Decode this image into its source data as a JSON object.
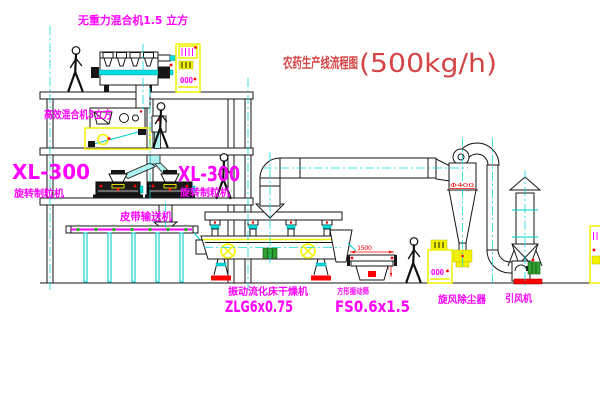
{
  "diagram": {
    "title": {
      "text": "农药生产线流程图",
      "capacity": "(500kg/h)"
    },
    "labels": {
      "zero_gravity_mixer": "无重力混合机1.5 立方",
      "high_efficiency_mixer": "高效混合机3立方",
      "granulator_left_model": "XL-300",
      "granulator_left_name": "旋转制粒机",
      "granulator_right_model": "XL-300",
      "granulator_right_name": "旋转制粒机",
      "belt_conveyor": "皮带输送机",
      "dryer_name": "振动流化床干燥机",
      "dryer_model": "ZLG6x0.75",
      "screen_name": "方形振动筛",
      "screen_model": "FS0.6x1.5",
      "cyclone": "旋风除尘器",
      "fan": "引风机"
    },
    "dimensions": {
      "screen_length": "1500",
      "screen_height": "600",
      "cyclone_diameter": "Φ400"
    },
    "cabinets": [
      {
        "display": "000"
      },
      {
        "display": "000"
      }
    ],
    "colors": {
      "label": "#ff00ff",
      "title": "#d64545",
      "equipment_accent": "#f2f200",
      "centerline": "#00d8d8",
      "dimension": "#ff0000",
      "machine_green": "#2fa32f"
    }
  }
}
